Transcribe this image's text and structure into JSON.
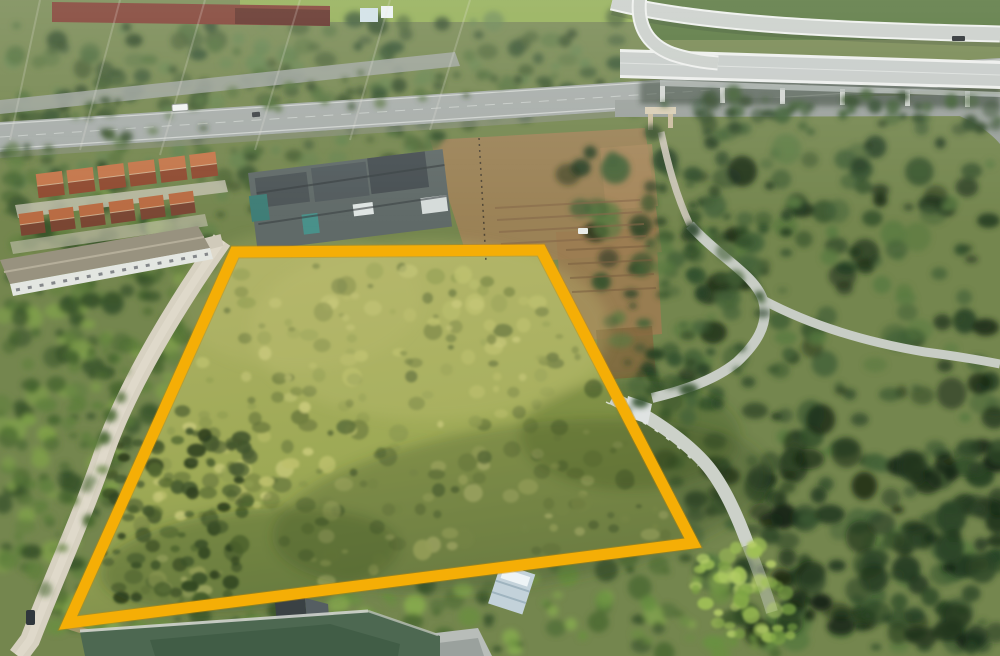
{
  "image": {
    "kind": "aerial-drone-photograph",
    "subject": "vacant grassy land plot outlined with a yellow boundary overlay",
    "setting": "suburban roadside: divided highway and elevated interchange at top, terracotta-roof townhouses at left, dense tree canopy at right, pond and houses at bottom",
    "visible_text": "none"
  },
  "boundary": {
    "type": "plot-outline-annotation",
    "points": "235,252 541,250 693,543 68,623",
    "color": "#F5AE06",
    "casing_color": "#C98A00",
    "stroke_width": 11
  },
  "palette": {
    "field_base": "#a3a95e",
    "field_light": "#bcc06c",
    "field_dark": "#5c6d38",
    "forest": "#33502c",
    "forest_deep": "#1d2f1a",
    "canopy_light": "#7fa04a",
    "asphalt_road": "#a6aca8",
    "concrete_road": "#d7d1c1",
    "overpass_concrete": "#c6cbc8",
    "roof_terracotta_lit": "#c4764a",
    "roof_terracotta_shade": "#8f4a30",
    "roof_slate": "#555e62",
    "dirt": "#a08258",
    "pond_water": "#4d6851"
  },
  "objects": {
    "vehicle_on_highway": "white pickup truck",
    "vehicle_on_side_road": "dark car",
    "vehicle_on_overpass": "dark car",
    "entrance_gate": "small beige arch gate on frontage path"
  }
}
